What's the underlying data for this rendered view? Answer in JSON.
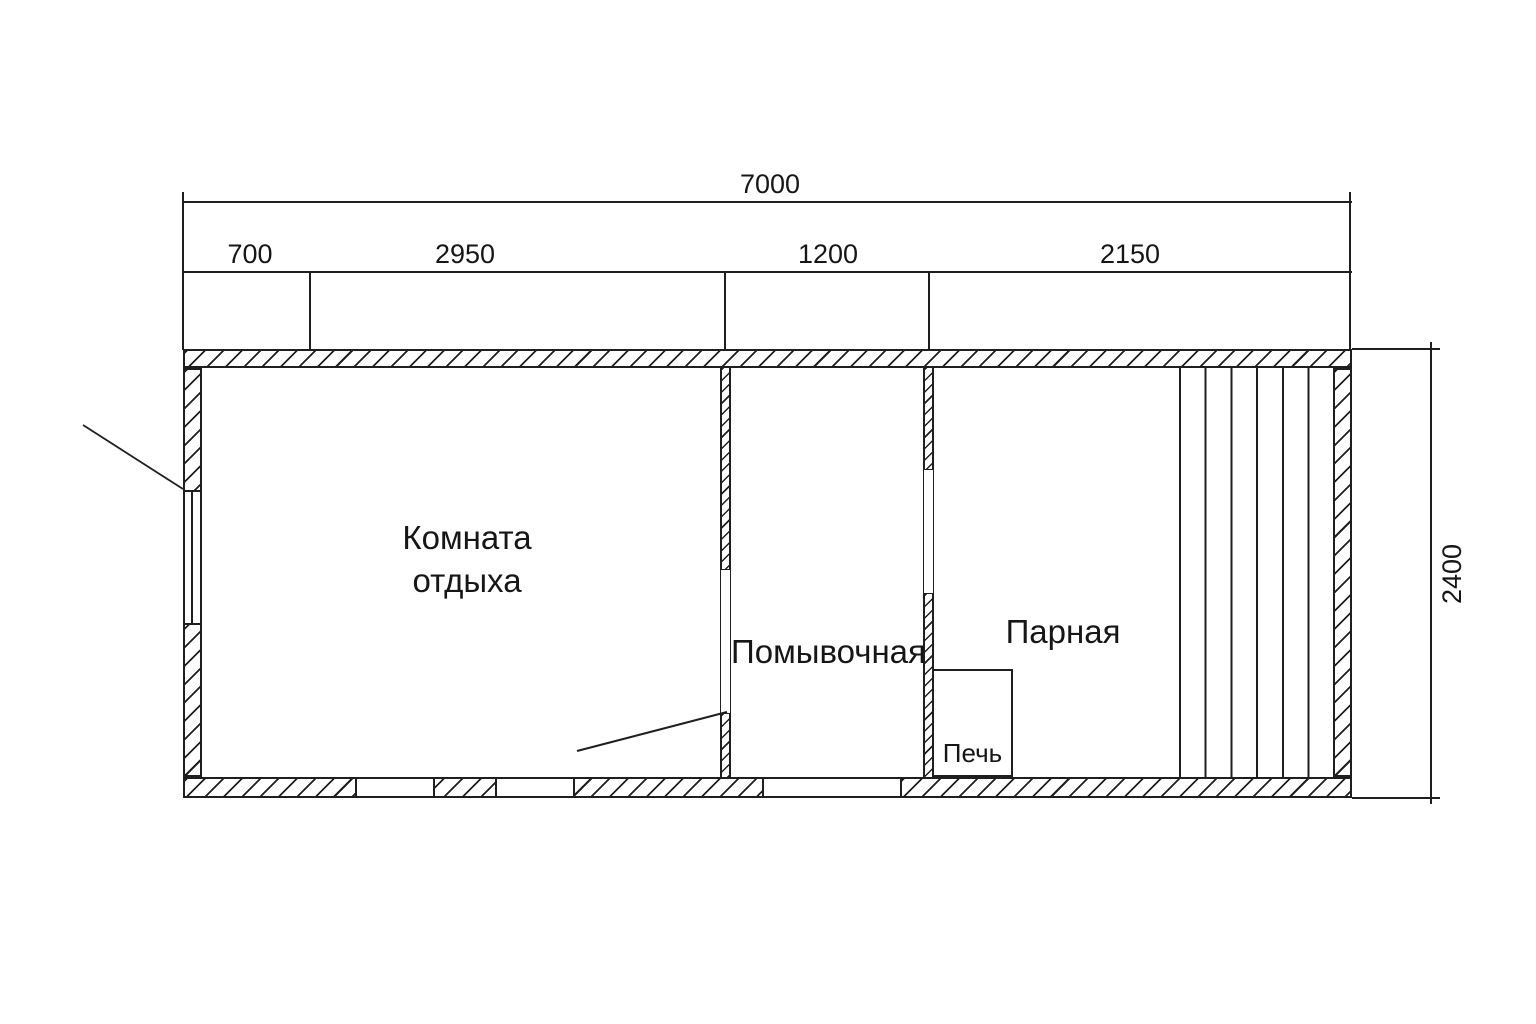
{
  "drawing": {
    "type": "bathhouse floor plan",
    "units": "mm"
  },
  "dimensions": {
    "overall_width": "7000",
    "overall_depth": "2400",
    "width_segments": [
      {
        "label": "700"
      },
      {
        "label": "2950"
      },
      {
        "label": "1200"
      },
      {
        "label": "2150"
      }
    ]
  },
  "rooms": {
    "rest_room_line1": "Комната",
    "rest_room_line2": "отдыха",
    "washing_room": "Помывочная",
    "steam_room": "Парная",
    "stove": "Печь"
  },
  "colors": {
    "line": "#1f1f1f",
    "background": "#ffffff"
  }
}
